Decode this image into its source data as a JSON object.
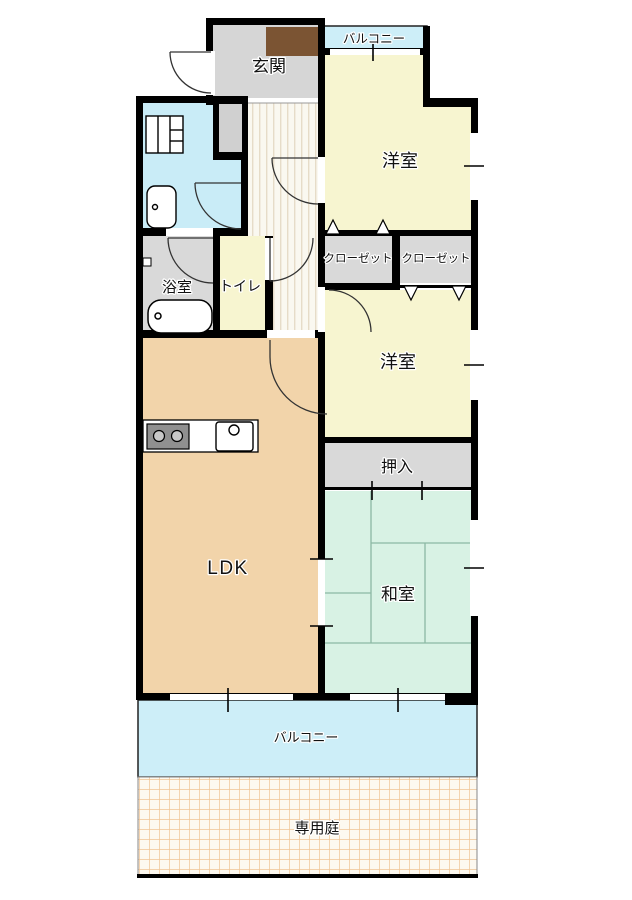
{
  "title": "apartment-floor-plan",
  "colors": {
    "wall": "#000000",
    "genkan_floor": "#d6d6d6",
    "shoe_cabinet": "#7b5433",
    "balcony": "#cdeef8",
    "western_room": "#f7f5d0",
    "toilet_room": "#f7f5d0",
    "closet": "#d9d9d9",
    "bathroom": "#d9d9d9",
    "washroom": "#c9ecf7",
    "hallway": "#faf8f0",
    "hallway_stripe": "#e6dcc8",
    "ldk": "#f2d4aa",
    "japanese_room": "#d8f2e4",
    "tatami_line": "#8cb8a4",
    "garden_bg": "#fdf9f0",
    "garden_line": "#f0c494",
    "fixture_fill": "#ffffff",
    "stove_body": "#909090",
    "niche": "#d0d0d0"
  },
  "rooms": {
    "genkan": {
      "label": "玄関"
    },
    "balcony_top": {
      "label": "バルコニー"
    },
    "western_top": {
      "label": "洋室"
    },
    "closet_left": {
      "label": "クローゼット"
    },
    "closet_right": {
      "label": "クローゼット"
    },
    "bathroom": {
      "label": "浴室"
    },
    "toilet": {
      "label": "トイレ"
    },
    "western_mid": {
      "label": "洋室"
    },
    "oshiire": {
      "label": "押入"
    },
    "ldk": {
      "label": "LDK"
    },
    "japanese_room": {
      "label": "和室"
    },
    "balcony_bottom": {
      "label": "バルコニー"
    },
    "garden": {
      "label": "専用庭"
    }
  },
  "fixtures": {
    "washbasin": "washbasin",
    "toilet_bowl": "toilet-bowl",
    "bathtub": "bathtub",
    "stove": "two-burner-stove",
    "sink": "kitchen-sink",
    "shoe_cabinet": "shoe-cabinet"
  }
}
